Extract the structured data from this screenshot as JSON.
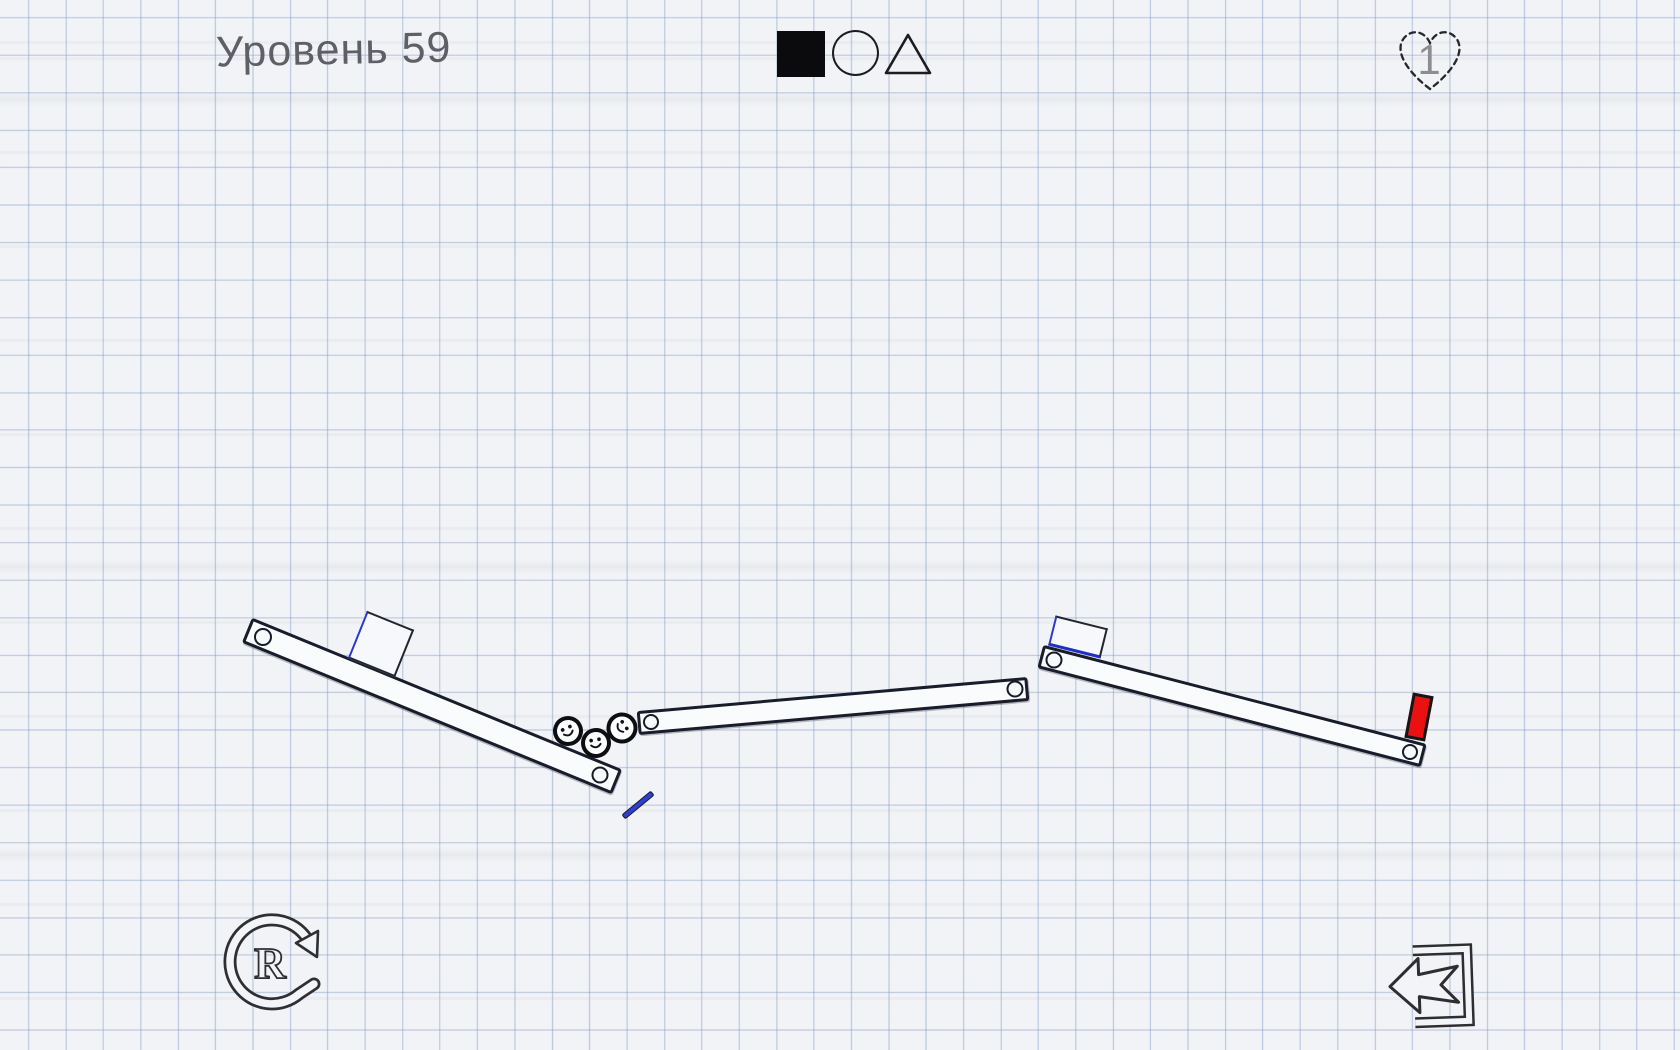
{
  "hud": {
    "level_label": "Уровень 59",
    "lives_count": "1",
    "restart_letter": "R",
    "tools": [
      {
        "id": "square-tool",
        "shape": "square",
        "style": "filled"
      },
      {
        "id": "circle-tool",
        "shape": "circle",
        "style": "outline"
      },
      {
        "id": "triangle-tool",
        "shape": "triangle",
        "style": "outline"
      }
    ]
  },
  "colors": {
    "paper": "#f1f3f6",
    "grid_line": "#a9bcd9",
    "ink": "#181c2b",
    "accent_blue": "#2b3bd0",
    "block_red": "#ea1113",
    "title_gray": "#53545a"
  },
  "objects": [
    {
      "name": "plank-left",
      "type": "plank",
      "x": 431.5,
      "y": 706,
      "w": 400,
      "h": 27,
      "angle": 22.3
    },
    {
      "name": "plank-middle",
      "type": "plank",
      "x": 832.5,
      "y": 706,
      "w": 392,
      "h": 24,
      "angle": -5
    },
    {
      "name": "plank-right",
      "type": "plank",
      "x": 1232,
      "y": 706,
      "w": 396,
      "h": 24,
      "angle": 14.5
    },
    {
      "name": "crate-left",
      "type": "box",
      "x": 380.5,
      "y": 643.5,
      "w": 51,
      "h": 51,
      "angle": 22
    },
    {
      "name": "crate-right",
      "type": "box",
      "x": 1077.5,
      "y": 636.5,
      "w": 54,
      "h": 31,
      "angle": 14,
      "variant": "blue-bottom"
    },
    {
      "name": "red-block",
      "type": "block",
      "x": 1418.5,
      "y": 717,
      "w": 21,
      "h": 46,
      "angle": 10.8
    },
    {
      "name": "drawn-stick",
      "type": "stick",
      "x": 637.5,
      "y": 805,
      "w": 38,
      "h": 6,
      "angle": -39.6
    },
    {
      "name": "hinge-pin",
      "type": "pin",
      "x": 263,
      "y": 637,
      "w": 18,
      "h": 18,
      "angle": 0
    },
    {
      "name": "hinge-pin",
      "type": "pin",
      "x": 600,
      "y": 775,
      "w": 17,
      "h": 17,
      "angle": 0
    },
    {
      "name": "hinge-pin",
      "type": "pin",
      "x": 651,
      "y": 722,
      "w": 16,
      "h": 16,
      "angle": 0
    },
    {
      "name": "hinge-pin",
      "type": "pin",
      "x": 1015,
      "y": 689,
      "w": 17,
      "h": 17,
      "angle": 0
    },
    {
      "name": "hinge-pin",
      "type": "pin",
      "x": 1054,
      "y": 660,
      "w": 17,
      "h": 17,
      "angle": 0
    },
    {
      "name": "hinge-pin",
      "type": "pin",
      "x": 1410,
      "y": 752,
      "w": 16,
      "h": 16,
      "angle": 0
    },
    {
      "name": "smiley-ball",
      "type": "ball",
      "x": 568,
      "y": 731,
      "w": 30,
      "h": 30,
      "angle": -25
    },
    {
      "name": "smiley-ball",
      "type": "ball",
      "x": 596,
      "y": 743,
      "w": 30,
      "h": 30,
      "angle": -10
    },
    {
      "name": "smiley-ball",
      "type": "ball",
      "x": 622,
      "y": 728,
      "w": 31,
      "h": 31,
      "angle": 55
    }
  ]
}
